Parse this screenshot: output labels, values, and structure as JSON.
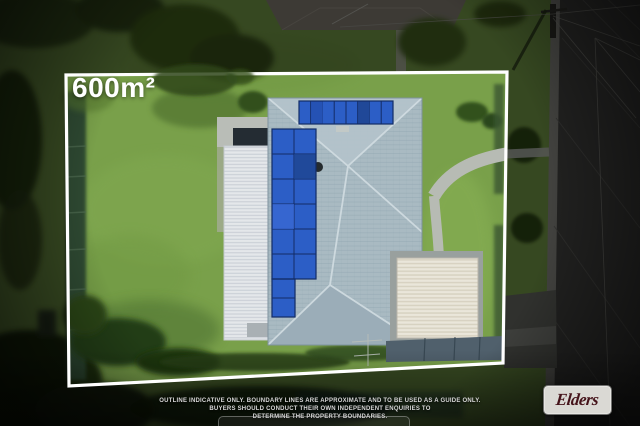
{
  "image": {
    "width": 640,
    "height": 426
  },
  "overlay": {
    "area_label": "600m²",
    "disclaimer": {
      "line1": "OUTLINE INDICATIVE ONLY. BOUNDARY LINES ARE APPROXIMATE AND TO BE USED AS A GUIDE ONLY.",
      "line2": "BUYERS SHOULD CONDUCT THEIR OWN INDEPENDENT ENQUIRIES TO",
      "line3": "DETERMINE THE PROPERTY BOUNDARIES."
    },
    "brand": {
      "name": "Elders"
    }
  },
  "colors": {
    "boundary_line": "#ffffff",
    "area_label_text": "#ffffff",
    "disclaimer_text": "#d8d8d8",
    "brand_bg": "#dad9d4",
    "brand_text": "#45131a",
    "lawn_green": "#79a04a",
    "roof_tile": "#a9bac2",
    "solar_panel_blue": "#2c5ec6",
    "patio_roof_white": "#e4e7ea",
    "garage_roof_cream": "#eae6da",
    "road_asphalt": "#4a4a48"
  },
  "scene": {
    "photo_features": [
      "aerial view of residential block",
      "house with grey hip tile roof",
      "rooftop solar panel arrays",
      "white corrugated patio awning",
      "detached cream garage",
      "lawn with tree shadows",
      "curved front path and driveway",
      "street with power pole and wires",
      "white property boundary outline"
    ]
  }
}
